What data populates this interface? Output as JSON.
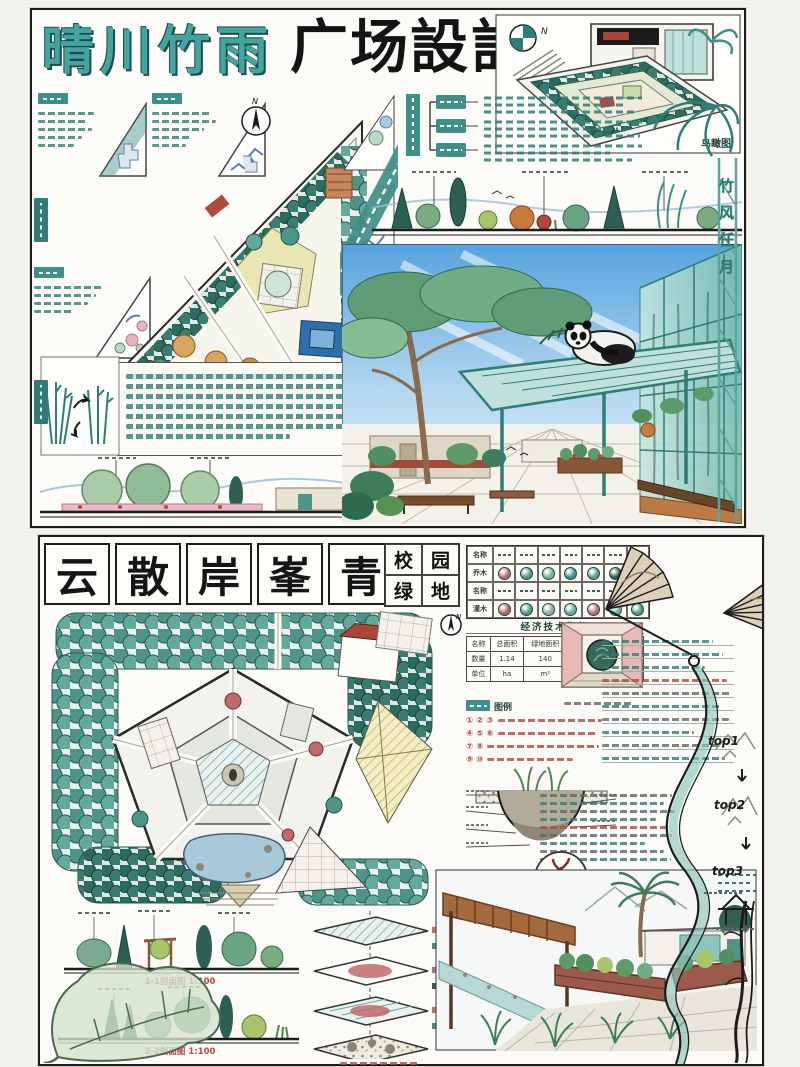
{
  "colors": {
    "teal_accent": "#3f8e87",
    "dark_teal": "#23625c",
    "ink": "#1a1a1a",
    "red_accent": "#b0493f",
    "sky_blue": "#6fb0e4",
    "green_wash": "#cfe7e3"
  },
  "board1": {
    "title_teal": "晴川竹雨",
    "title_black": "广场設計",
    "north_label": "N",
    "aerial_label": "鸟瞰图",
    "vertical_motto": "竹风任月"
  },
  "board2": {
    "title_chars": [
      "云",
      "散",
      "岸",
      "峯",
      "青"
    ],
    "subtitle_chars": [
      "校",
      "园",
      "绿",
      "地"
    ],
    "plant_legend": {
      "row_labels": [
        "名称",
        "乔木",
        "名称",
        "灌木"
      ]
    },
    "indicator_table": {
      "title": "经济技术指标",
      "headers": [
        "名称",
        "总面积",
        "绿地面积",
        "水体面积",
        "绿地率"
      ],
      "rows": [
        [
          "数量",
          "1.14",
          "140",
          "300",
          "75%"
        ],
        [
          "单位",
          "ha",
          "m²",
          "m²",
          "绿化比"
        ]
      ]
    },
    "legend_label": "图例",
    "legend_lines": [
      "① ② ③",
      "④ ⑤ ⑥",
      "⑦ ⑧",
      "⑨ ⑩"
    ],
    "rain_garden_caption": "雨水花园做法详图",
    "top_labels": [
      "top1",
      "top2",
      "top3"
    ],
    "section_labels": [
      "1-1剖面图 1:100",
      "2-2剖面图 1:100"
    ],
    "north_label": "N"
  }
}
